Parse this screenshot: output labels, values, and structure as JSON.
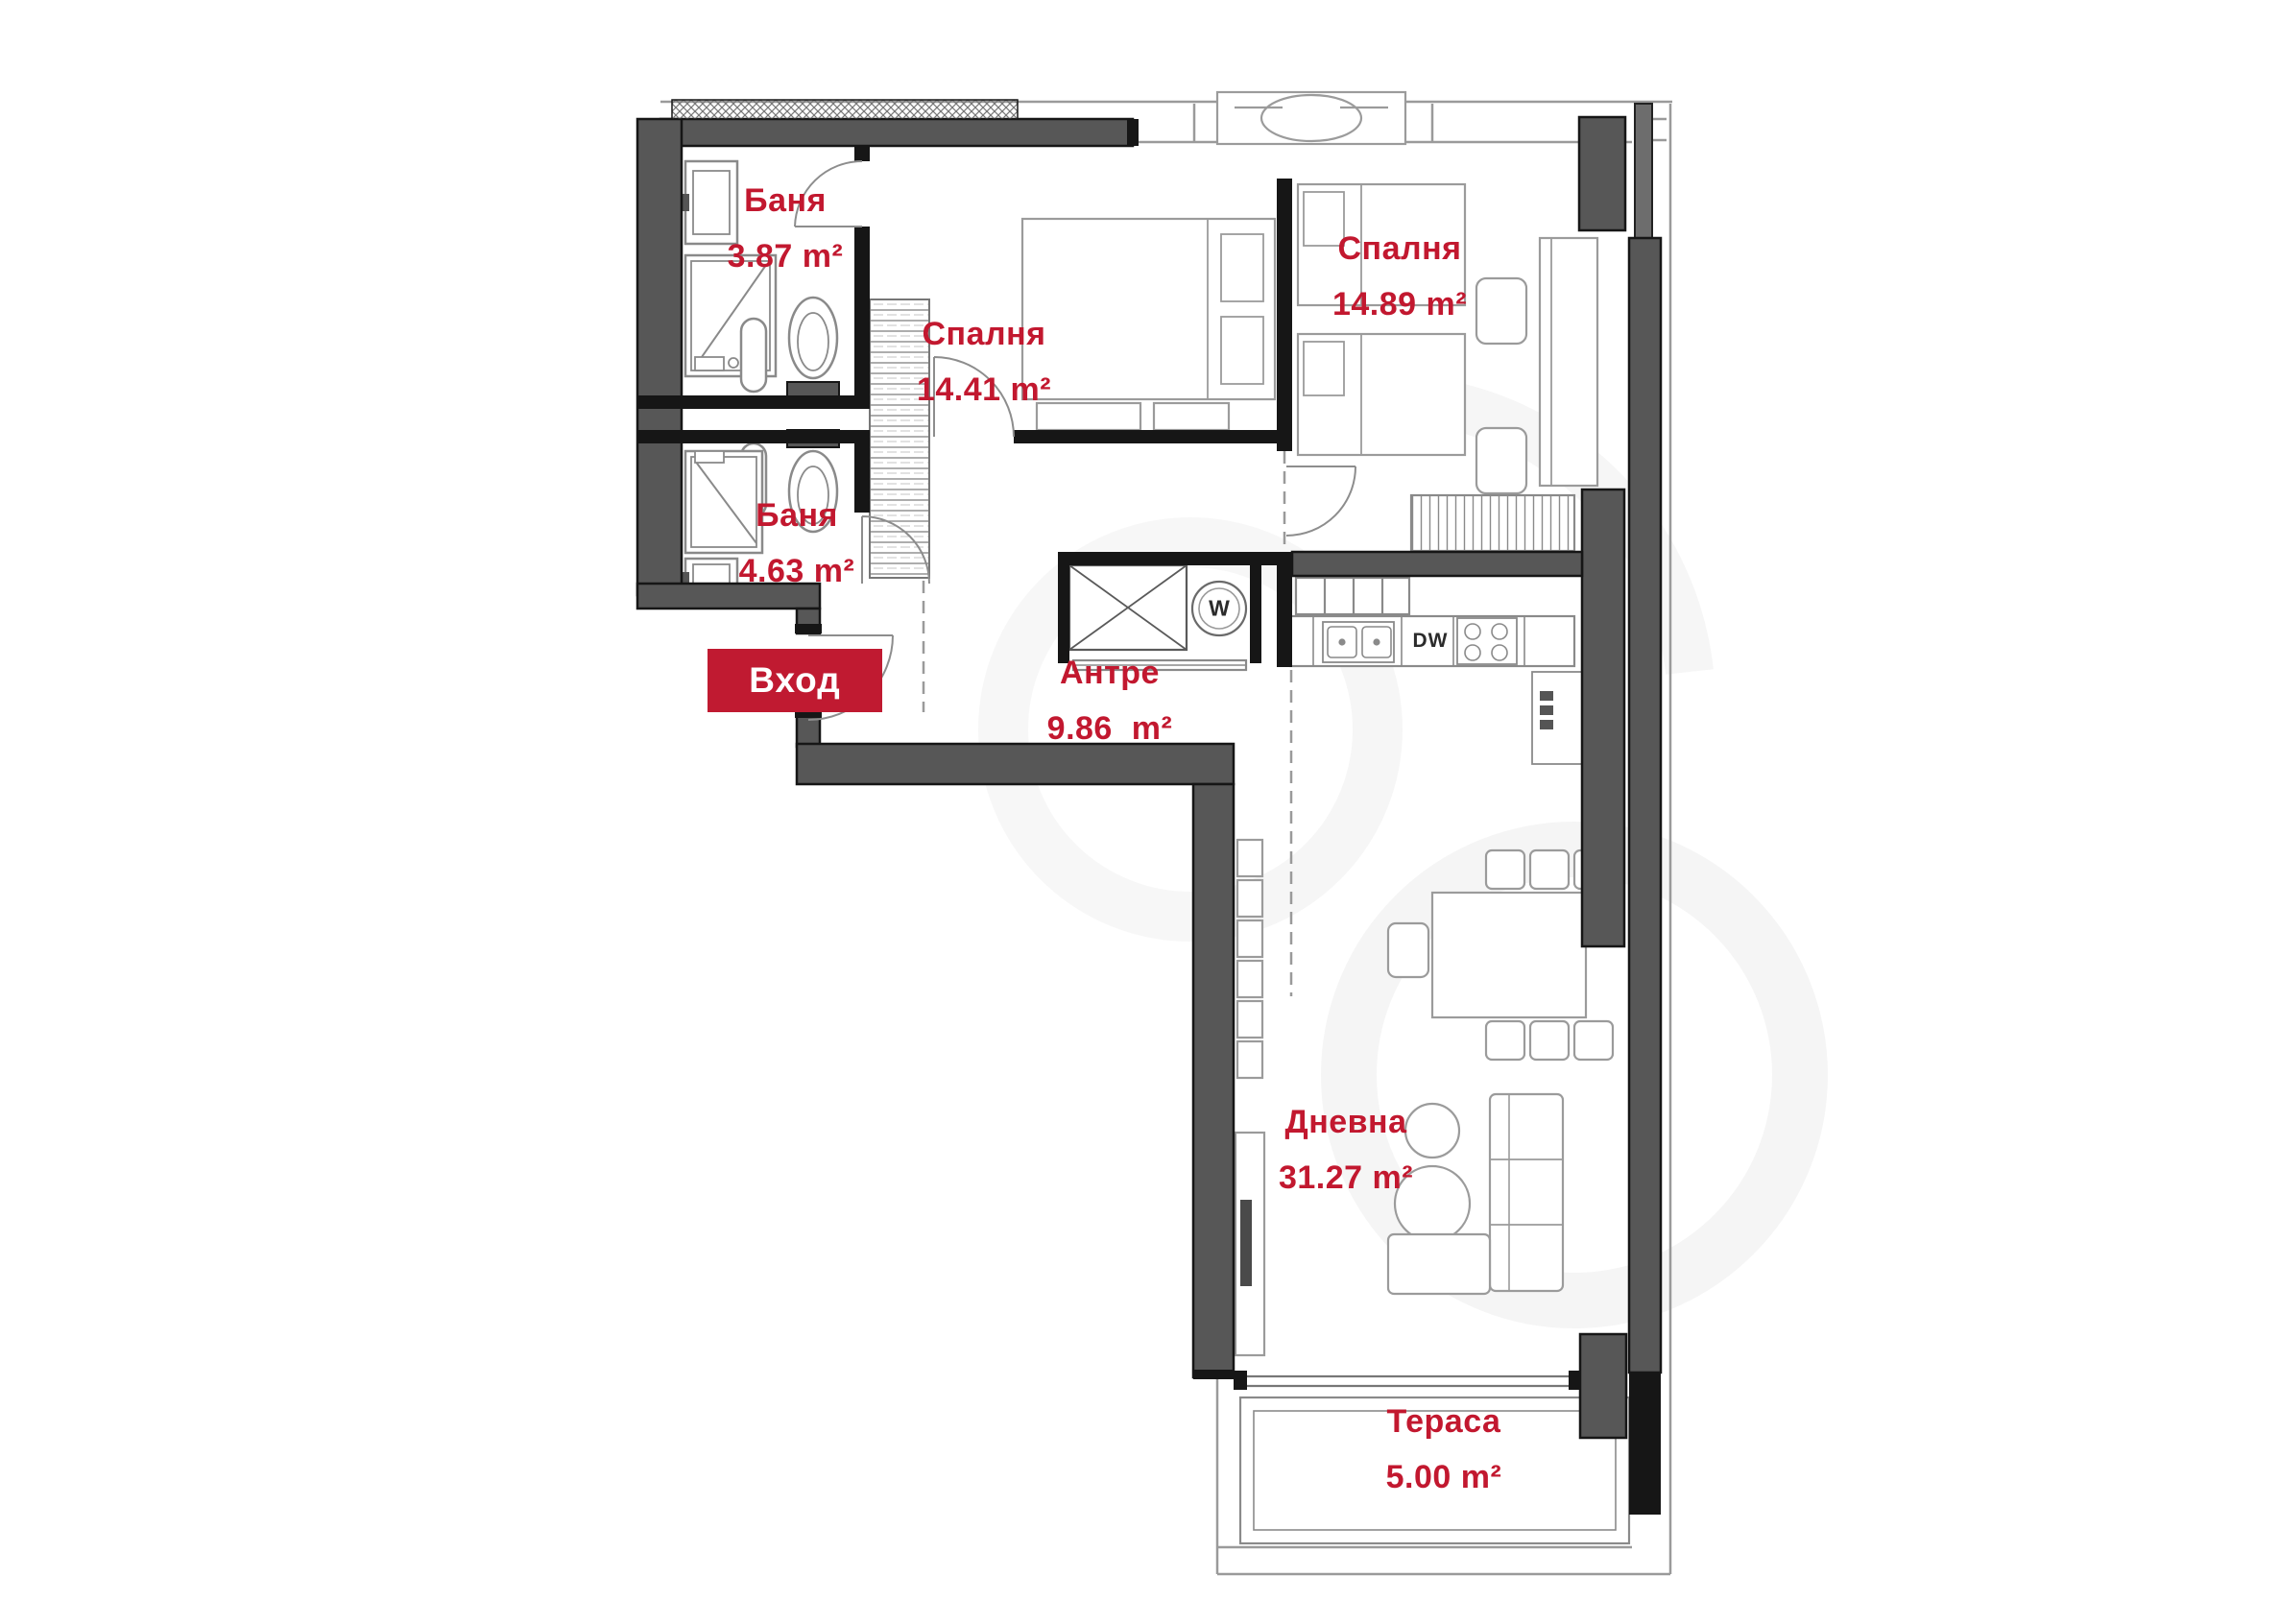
{
  "plan": {
    "entrance": {
      "label": "Вход"
    },
    "rooms": [
      {
        "id": "bathroom-1",
        "name": "Баня",
        "area": "3.87",
        "unit": "m²"
      },
      {
        "id": "bedroom-1",
        "name": "Спалня",
        "area": "14.41",
        "unit": "m²"
      },
      {
        "id": "bedroom-2",
        "name": "Спалня",
        "area": "14.89",
        "unit": "m²"
      },
      {
        "id": "bathroom-2",
        "name": "Баня",
        "area": "4.63",
        "unit": "m²"
      },
      {
        "id": "hallway",
        "name": "Антре",
        "area": "9.86",
        "unit": "m²"
      },
      {
        "id": "living-room",
        "name": "Дневна",
        "area": "31.27",
        "unit": "m²"
      },
      {
        "id": "terrace",
        "name": "Тераса",
        "area": "5.00",
        "unit": "m²"
      }
    ],
    "appliances": {
      "dishwasher": "DW",
      "washing_machine": "W"
    },
    "colors": {
      "label_red": "#c2182f",
      "badge_red": "#c01a31",
      "wall_gray": "#575757",
      "wall_black": "#161616"
    }
  }
}
